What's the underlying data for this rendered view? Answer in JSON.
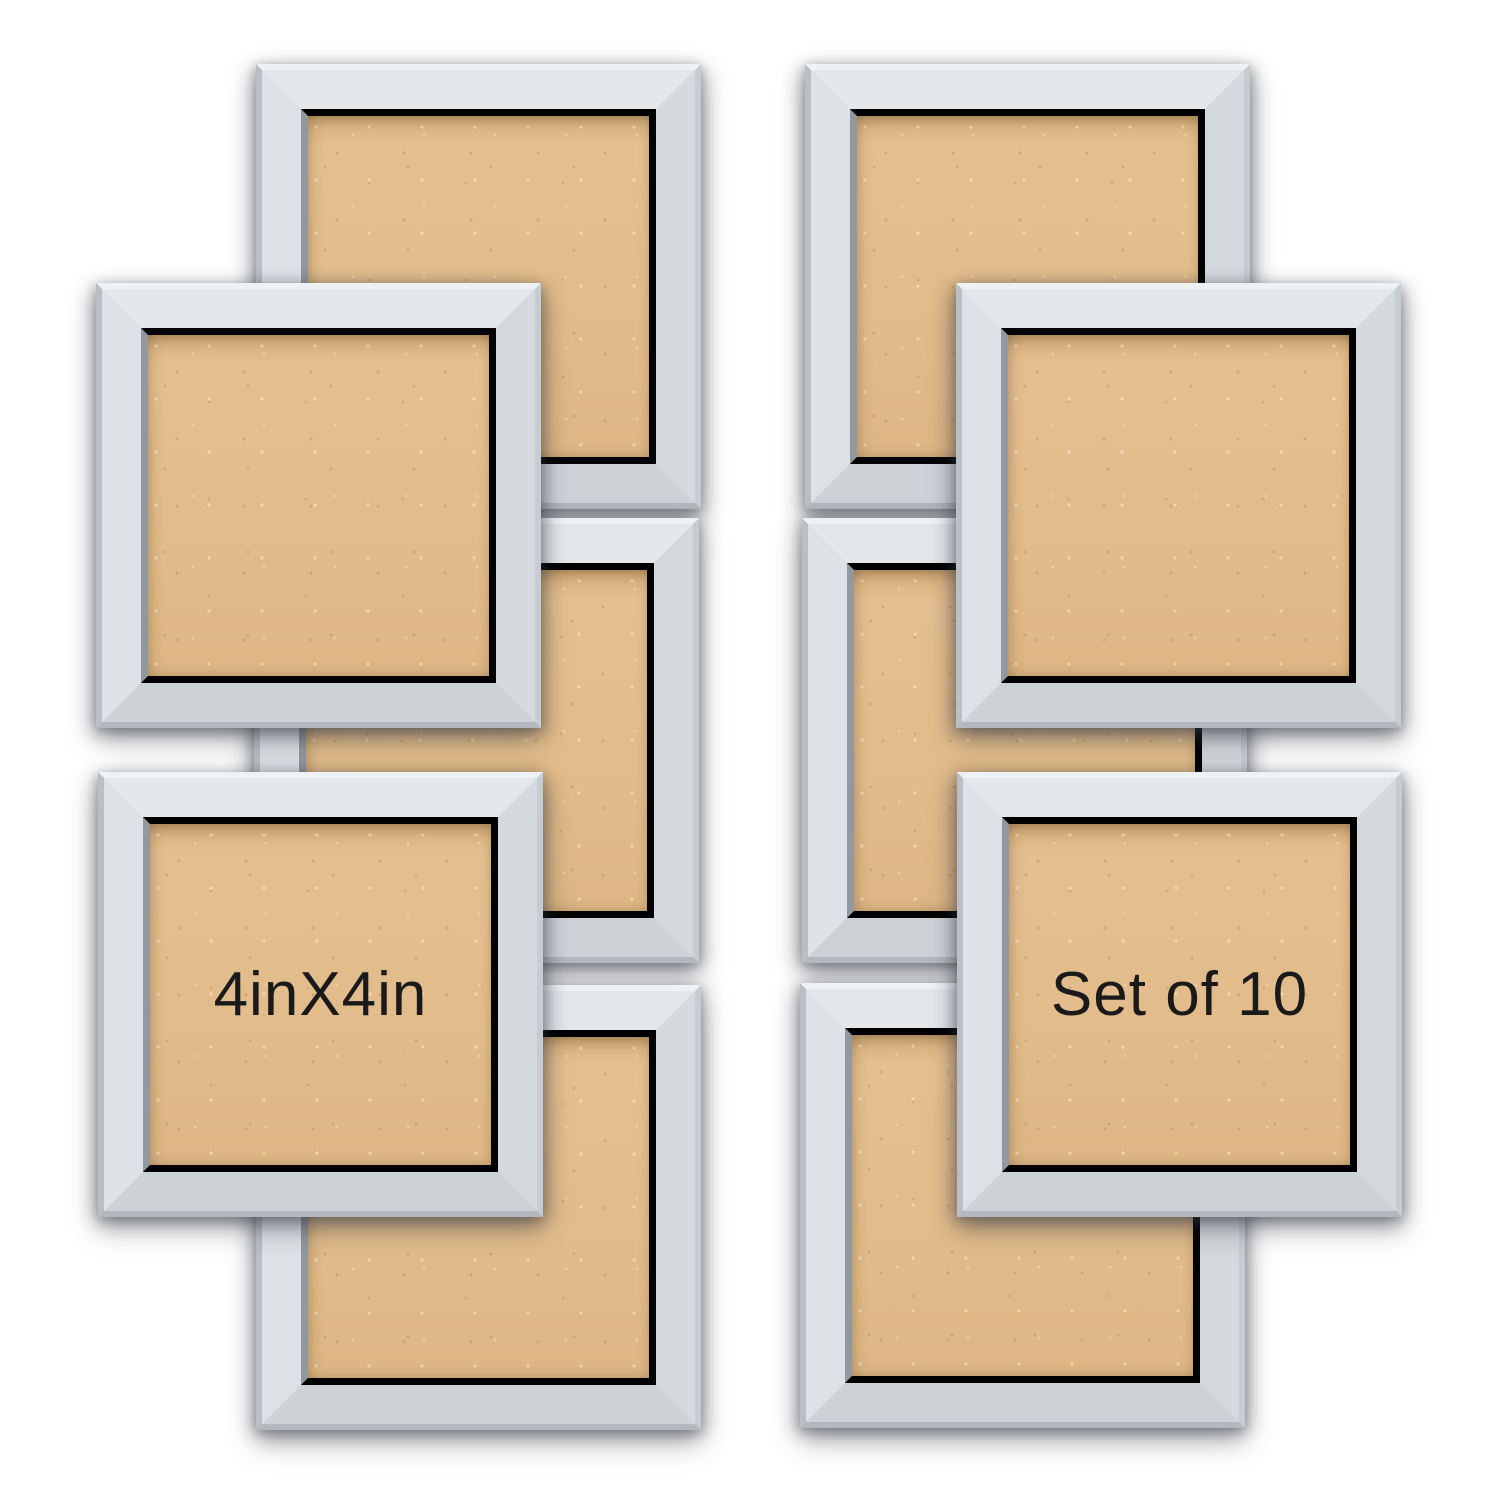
{
  "canvas": {
    "width": 1500,
    "height": 1500,
    "background_color": "#ffffff"
  },
  "product": {
    "description": "set of square picture frames with kraft backing boards",
    "frame_color": "#d6dbdf",
    "backing_color": "#e0b987",
    "label_text_color": "#1a1a1a",
    "frame_size_px": 445
  },
  "labels": {
    "size_label": "4inX4in",
    "set_count_label": "Set of 10"
  },
  "frames": [
    {
      "name": "frame-top-left-back",
      "x": 256,
      "y": 64,
      "z": 1,
      "label": ""
    },
    {
      "name": "frame-upper-left-front",
      "x": 96,
      "y": 283,
      "z": 2,
      "label": ""
    },
    {
      "name": "frame-middle-left-back",
      "x": 254,
      "y": 518,
      "z": 1,
      "label": ""
    },
    {
      "name": "frame-lower-left-front",
      "x": 98,
      "y": 772,
      "z": 2,
      "label": "4inX4in"
    },
    {
      "name": "frame-bottom-left-back",
      "x": 256,
      "y": 985,
      "z": 1,
      "label": ""
    },
    {
      "name": "frame-top-right-back",
      "x": 805,
      "y": 64,
      "z": 1,
      "label": ""
    },
    {
      "name": "frame-upper-right-front",
      "x": 956,
      "y": 283,
      "z": 2,
      "label": ""
    },
    {
      "name": "frame-middle-right-back",
      "x": 802,
      "y": 518,
      "z": 1,
      "label": ""
    },
    {
      "name": "frame-lower-right-front",
      "x": 957,
      "y": 772,
      "z": 2,
      "label": "Set of 10"
    },
    {
      "name": "frame-bottom-right-back",
      "x": 800,
      "y": 983,
      "z": 1,
      "label": ""
    }
  ]
}
